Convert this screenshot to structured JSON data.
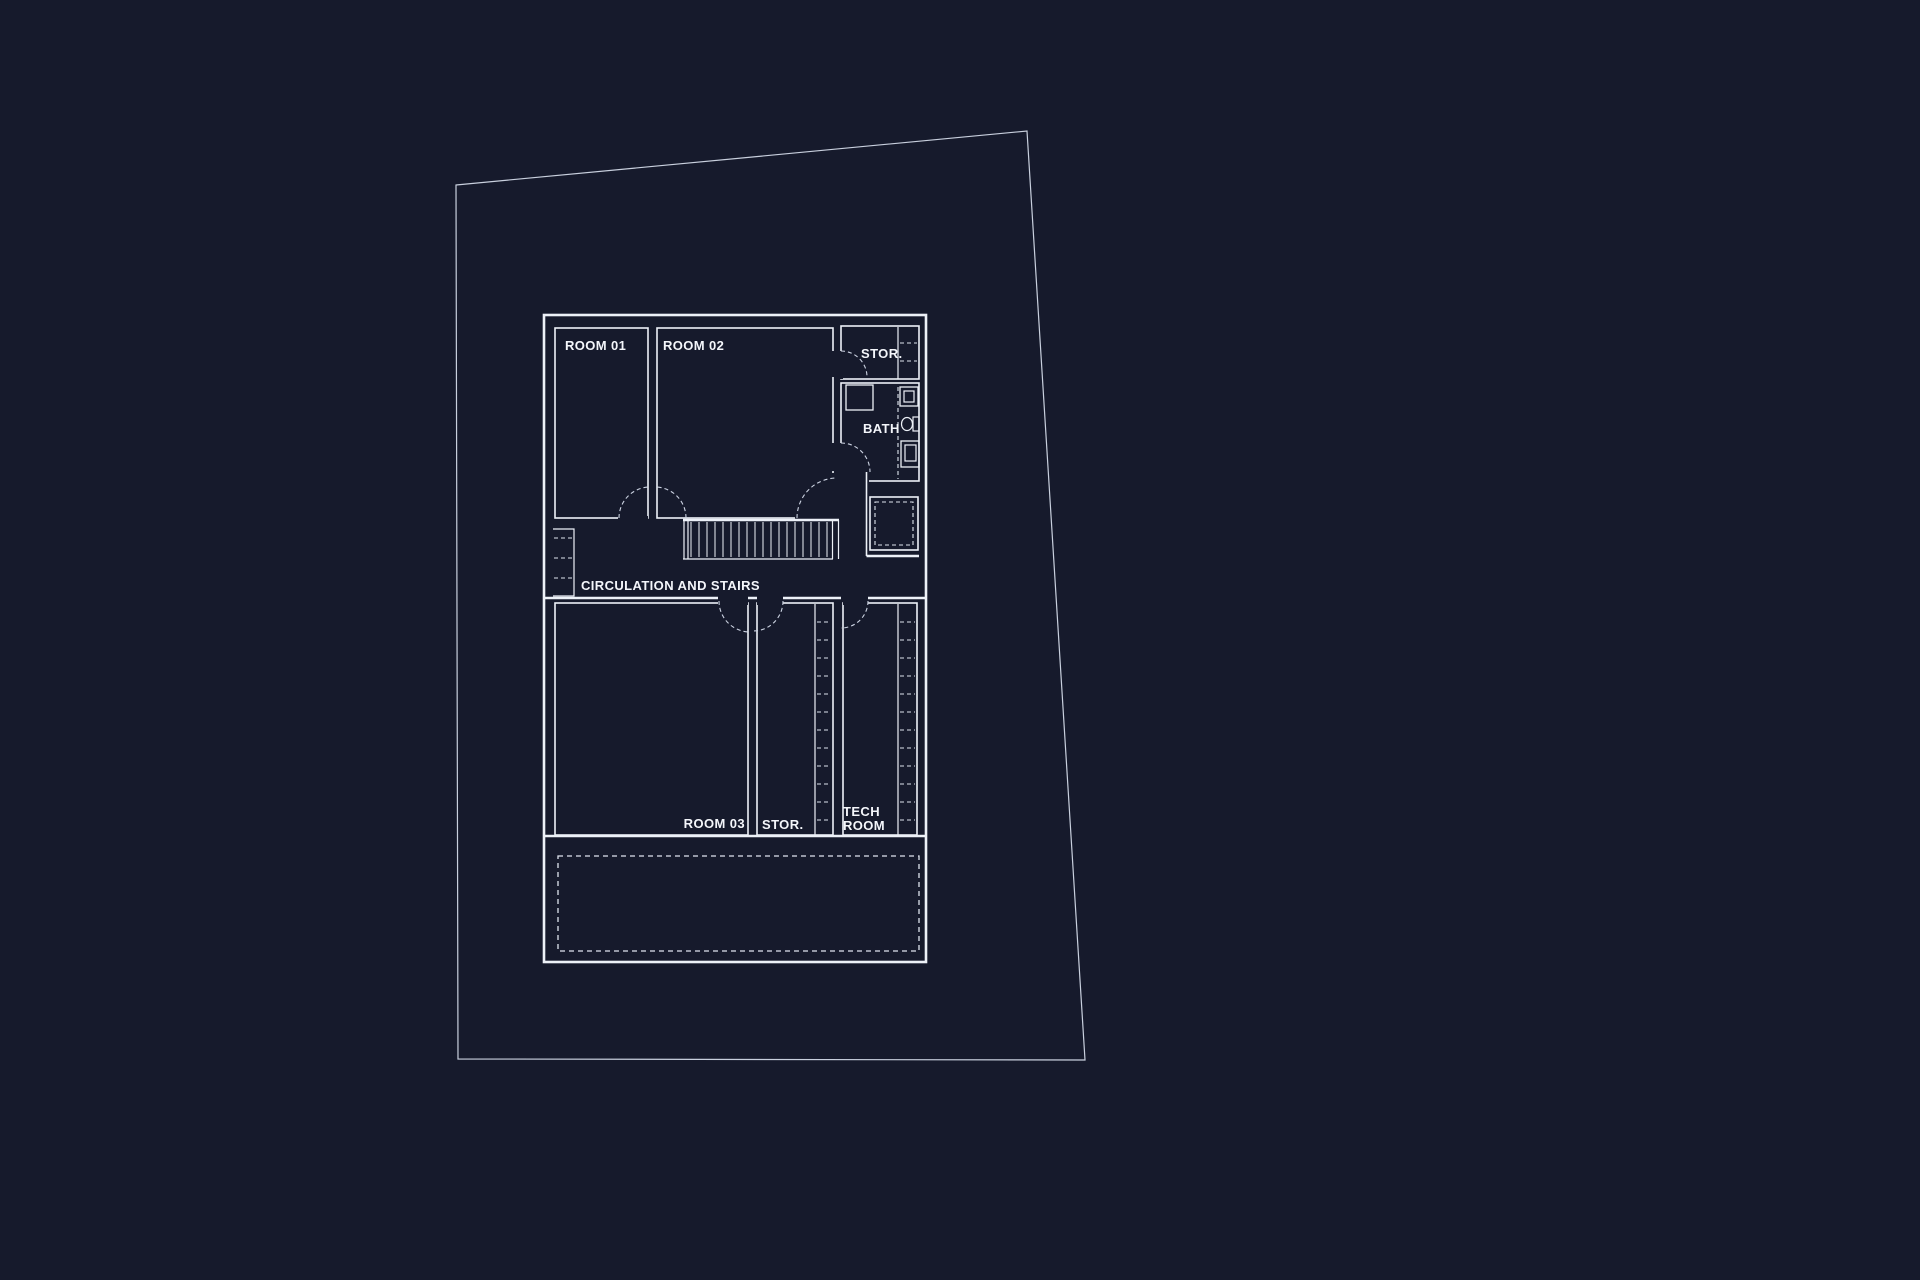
{
  "drawing": {
    "labels": {
      "room01": "ROOM 01",
      "room02": "ROOM 02",
      "stor_top": "STOR.",
      "bath": "BATH",
      "circulation": "CIRCULATION AND STAIRS",
      "room03": "ROOM 03",
      "stor_bottom": "STOR.",
      "tech_line1": "TECH",
      "tech_line2": "ROOM"
    },
    "colors": {
      "background": "#161a2c",
      "wall_line": "#edf1f8",
      "site_boundary_line": "#c9d0de",
      "dashed_line": "#dfe4ee"
    }
  }
}
